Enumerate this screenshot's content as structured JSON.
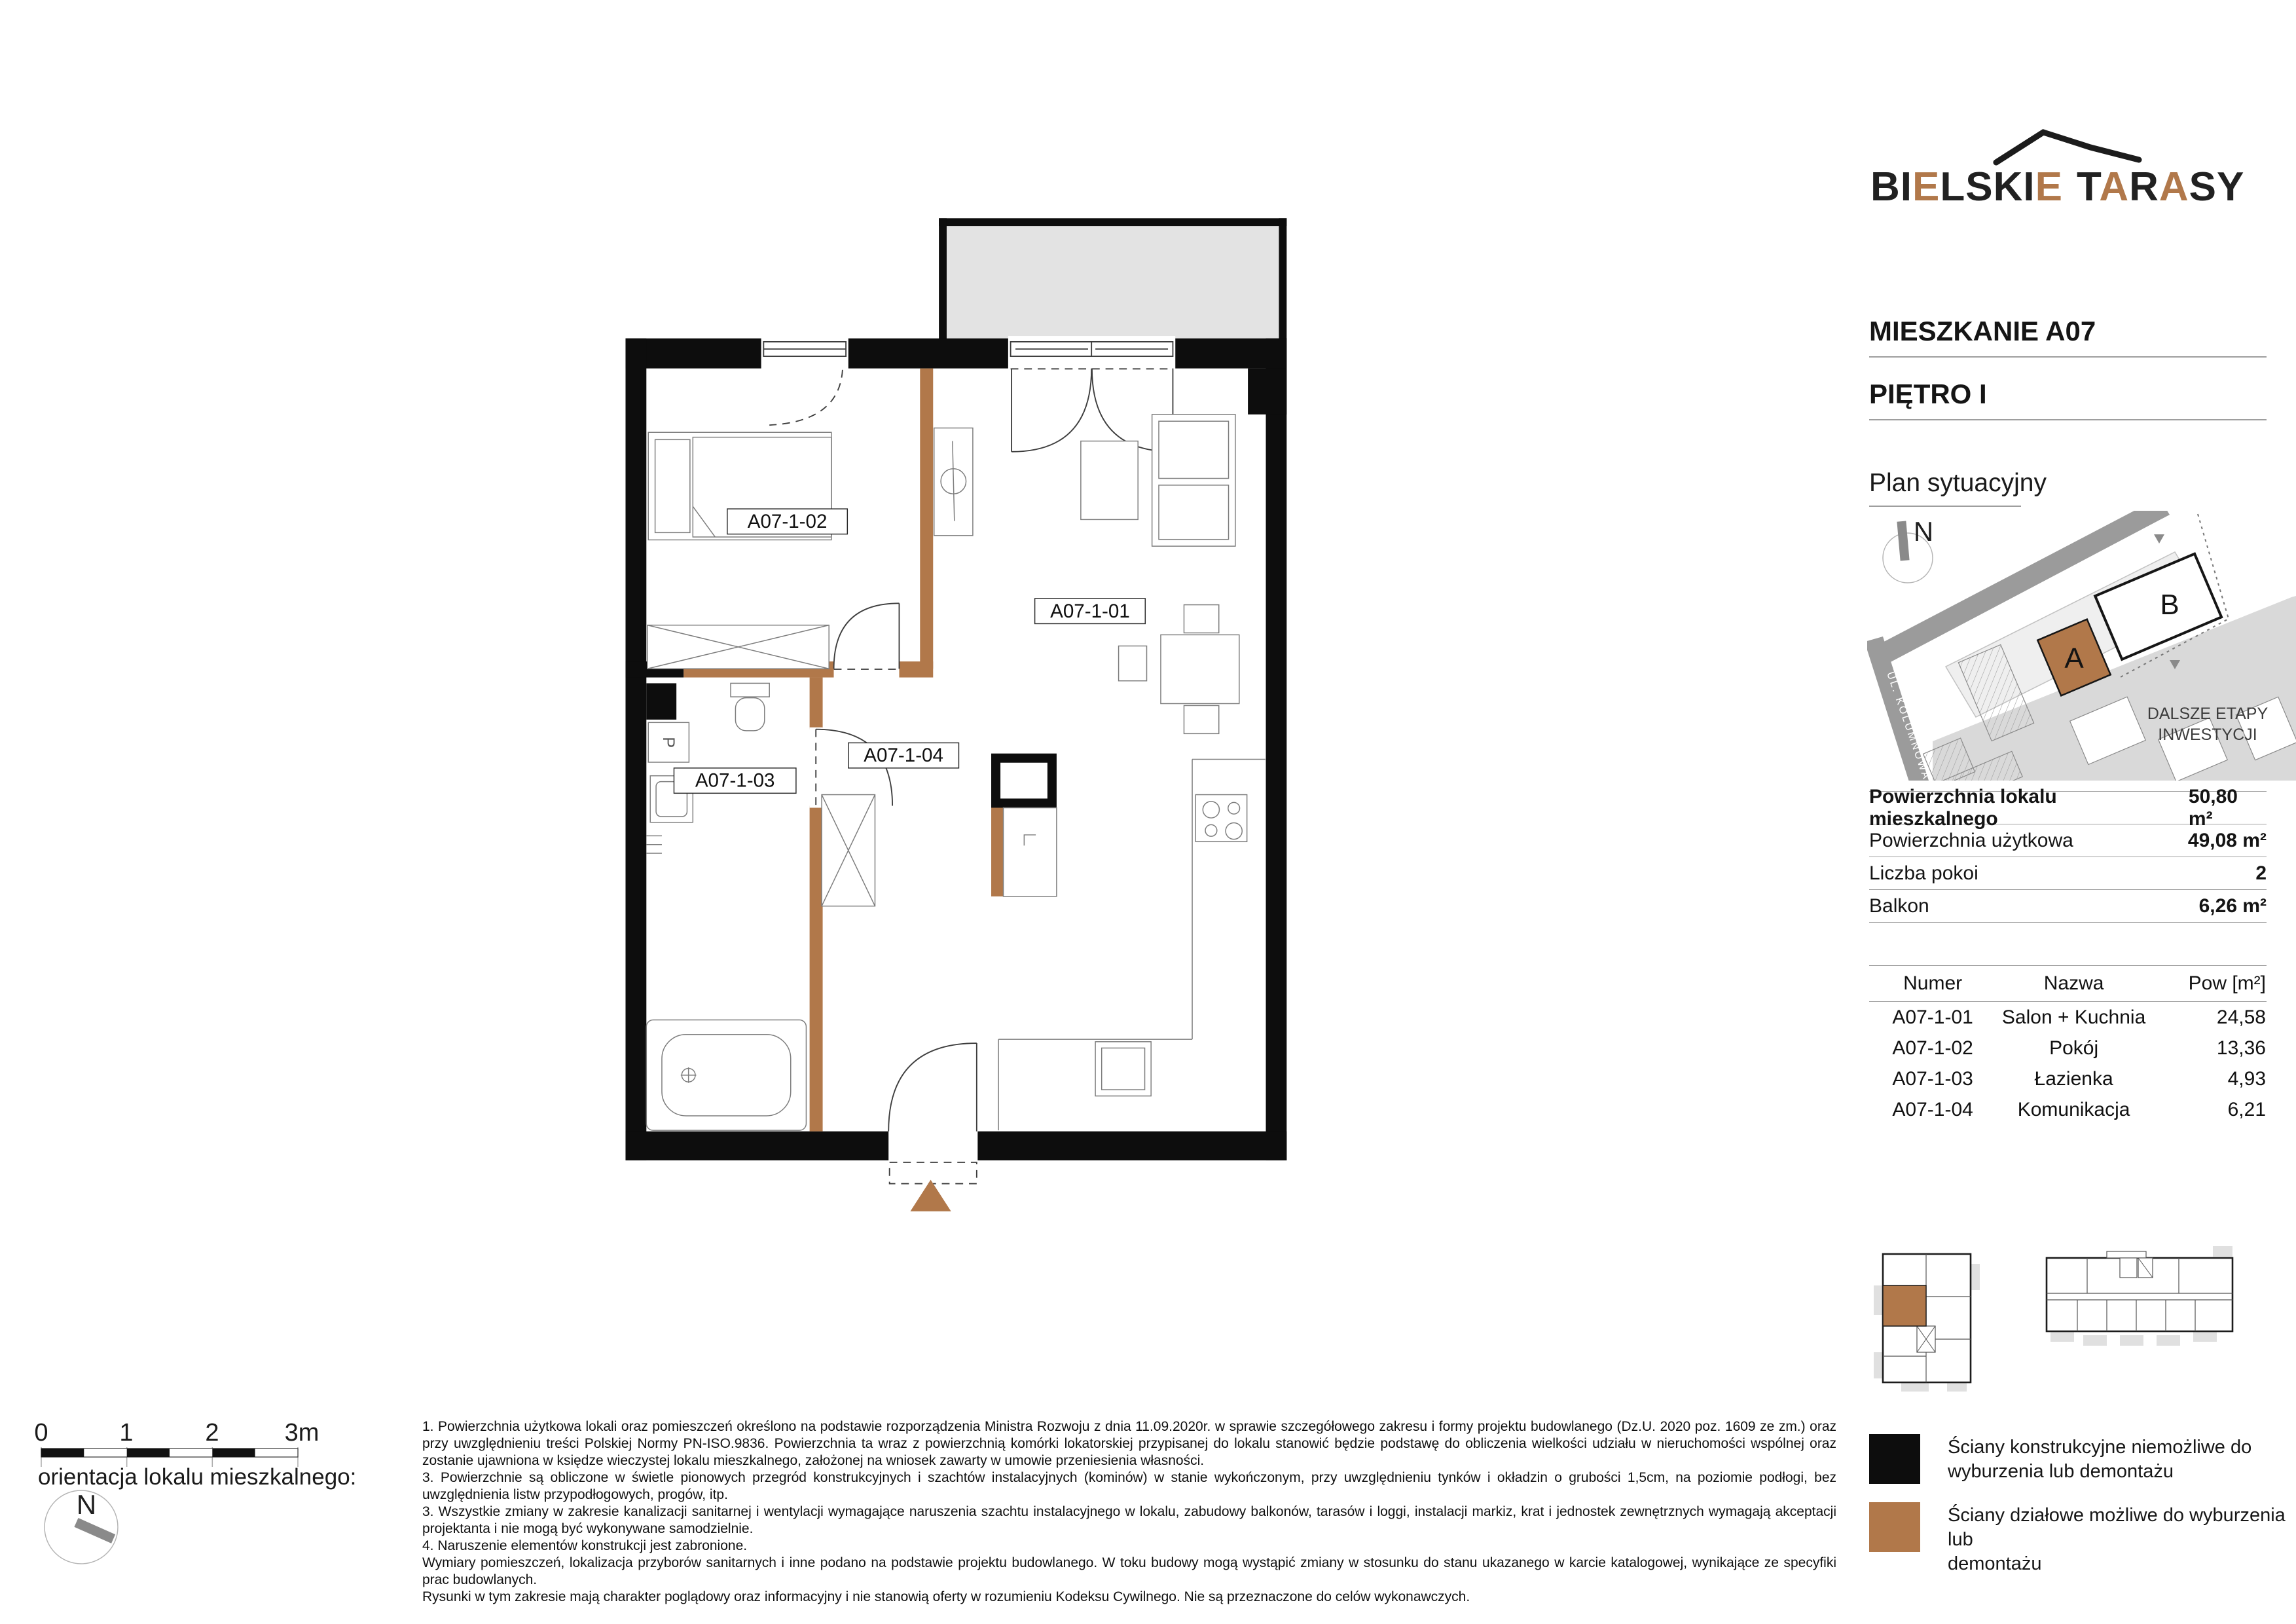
{
  "colors": {
    "accent": "#b1784a",
    "wall": "#0d0d0d",
    "balcony": "#e3e3e3",
    "street": "#9b9b9b",
    "future": "#d9d9d9",
    "parcel": "#efefef",
    "rule": "#9e9e9e",
    "pad": "#e0e0e0"
  },
  "logo": {
    "parts": [
      "BI",
      "E",
      "LSKI",
      "E",
      "T",
      "A",
      "R",
      "A",
      "SY"
    ]
  },
  "header": {
    "apartment": "MIESZKANIE A07",
    "floor": "PIĘTRO I"
  },
  "site_plan": {
    "title": "Plan sytuacyjny",
    "north": "N",
    "street_filarowa": "UL. FILAROWA",
    "street_kolumnowa": "UL. KOLUMNOWA",
    "building_a": "A",
    "building_b": "B",
    "future_line1": "DALSZE ETAPY",
    "future_line2": "INWESTYCJI"
  },
  "summary": {
    "rows": [
      {
        "label": "Powierzchnia lokalu mieszkalnego",
        "value": "50,80 m²"
      },
      {
        "label": "Powierzchnia użytkowa",
        "value": "49,08 m²"
      },
      {
        "label": "Liczba pokoi",
        "value": "2"
      },
      {
        "label": "Balkon",
        "value": "6,26 m²"
      }
    ]
  },
  "rooms": {
    "col_number": "Numer",
    "col_name": "Nazwa",
    "col_area": "Pow [m²]",
    "rows": [
      {
        "number": "A07-1-01",
        "name": "Salon + Kuchnia",
        "area": "24,58"
      },
      {
        "number": "A07-1-02",
        "name": "Pokój",
        "area": "13,36"
      },
      {
        "number": "A07-1-03",
        "name": "Łazienka",
        "area": "4,93"
      },
      {
        "number": "A07-1-04",
        "name": "Komunikacja",
        "area": "6,21"
      }
    ]
  },
  "plan": {
    "labels": {
      "salon": "A07-1-01",
      "pokoj": "A07-1-02",
      "lazienka": "A07-1-03",
      "komunikacja": "A07-1-04"
    },
    "washer": "P"
  },
  "scale": {
    "labels": [
      "0",
      "1",
      "2",
      "3m"
    ]
  },
  "orientation": {
    "caption": "orientacja lokalu mieszkalnego:",
    "north": "N"
  },
  "legend": {
    "items": [
      {
        "line1": "Ściany konstrukcyjne niemożliwe do",
        "line2": "wyburzenia lub demontażu"
      },
      {
        "line1": "Ściany działowe możliwe do wyburzenia lub",
        "line2": "demontażu"
      }
    ]
  },
  "disclaimer": [
    "1. Powierzchnia użytkowa lokali oraz pomieszczeń określono na podstawie rozporządzenia Ministra Rozwoju z dnia 11.09.2020r. w sprawie szczegółowego zakresu i formy projektu budowlanego (Dz.U. 2020 poz. 1609 ze zm.) oraz przy uwzględnieniu treści Polskiej Normy PN-ISO.9836. Powierzchnia ta wraz z powierzchnią komórki lokatorskiej przypisanej do lokalu stanowić będzie podstawę do obliczenia wielkości udziału w nieruchomości wspólnej oraz zostanie ujawniona w księdze wieczystej lokalu mieszkalnego, założonej na wniosek zawarty w umowie przeniesienia własności.",
    "3. Powierzchnie są obliczone w świetle pionowych przegród konstrukcyjnych i szachtów instalacyjnych (kominów) w stanie wykończonym, przy uwzględnieniu tynków i okładzin o grubości 1,5cm, na poziomie podłogi, bez uwzględnienia listw przypodłogowych, progów, itp.",
    "3. Wszystkie zmiany w zakresie kanalizacji sanitarnej i wentylacji wymagające naruszenia szachtu instalacyjnego w lokalu, zabudowy balkonów, tarasów i loggi, instalacji markiz, krat i jednostek zewnętrznych wymagają akceptacji projektanta i nie mogą być wykonywane samodzielnie.",
    "4. Naruszenie elementów konstrukcji jest zabronione.",
    "Wymiary pomieszczeń, lokalizacja przyborów sanitarnych i inne podano na podstawie projektu budowlanego. W toku budowy mogą wystąpić zmiany w stosunku do stanu ukazanego w karcie katalogowej, wynikające ze specyfiki prac budowlanych.",
    "Rysunki w tym zakresie mają charakter poglądowy oraz informacyjny i nie stanowią oferty w rozumieniu Kodeksu Cywilnego. Nie są przeznaczone do celów wykonawczych."
  ]
}
